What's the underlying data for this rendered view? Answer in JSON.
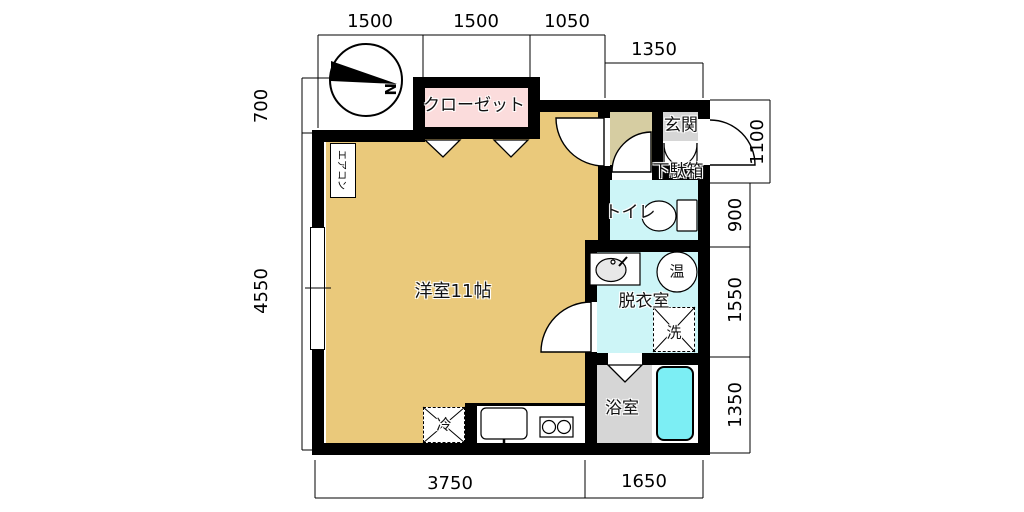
{
  "floorplan": {
    "compass": {
      "north_label": "N"
    },
    "rooms": {
      "main": {
        "label": "洋室11帖"
      },
      "closet": {
        "label": "クローゼット"
      },
      "entrance": {
        "label": "玄関"
      },
      "shoe_box": {
        "label": "下駄箱"
      },
      "toilet": {
        "label": "トイレ"
      },
      "dressing": {
        "label": "脱衣室"
      },
      "bath": {
        "label": "浴室"
      }
    },
    "fixtures": {
      "washer_space": {
        "label": "洗"
      },
      "water_heater": {
        "label": "温"
      },
      "fridge_space": {
        "label": "冷"
      },
      "aircon": {
        "label": "エアコン"
      }
    },
    "dimensions": {
      "top": [
        "1500",
        "1500",
        "1050"
      ],
      "top_right": "1350",
      "left": [
        "700",
        "4550"
      ],
      "right": [
        "1100",
        "900",
        "1550",
        "1350"
      ],
      "bottom": [
        "3750",
        "1650"
      ]
    },
    "colors": {
      "room-gold": "#EAC97B",
      "hall-khaki": "#D6CDA2",
      "closet-pink": "#FBDCDC",
      "wet-cyan": "#CDF5F7",
      "tub-cyan": "#7CEEF4",
      "floor-gray": "#D6D6D6",
      "wall-black": "#000000"
    }
  }
}
